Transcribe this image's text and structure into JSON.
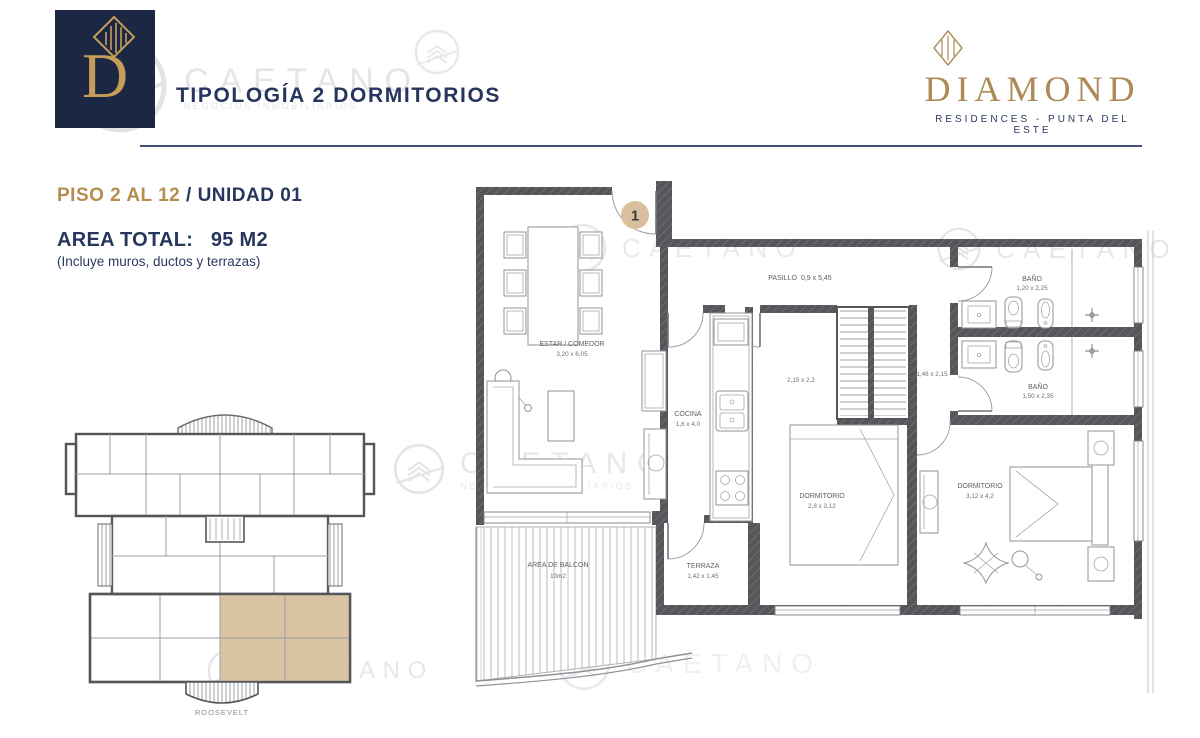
{
  "header": {
    "logo_letter": "D",
    "title": "TIPOLOGÍA 2 DORMITORIOS",
    "brand_name": "DIAMOND",
    "brand_subtitle": "RESIDENCES - PUNTA DEL ESTE"
  },
  "unit_info": {
    "floor_range": "PISO 2 AL 12",
    "separator": "/",
    "unit": "UNIDAD 01",
    "area_label": "AREA TOTAL:",
    "area_value": "95 M2",
    "area_note": "(Incluye muros, ductos y terrazas)"
  },
  "floorplan": {
    "entrance_number": "1",
    "rooms": {
      "estar": {
        "name": "ESTAR / COMEDOR",
        "dims": "3,20 x 6,05"
      },
      "pasillo": {
        "name": "PASILLO",
        "dims": "0,9 x 5,45"
      },
      "cocina": {
        "name": "COCINA",
        "dims": "1,6 x 4,0"
      },
      "vestidor": {
        "dims": "2,15 x 2,2"
      },
      "hall": {
        "dims": "1,46 x 2,15"
      },
      "banio_1": {
        "name": "BAÑO",
        "dims": "1,20 x 2,25"
      },
      "banio_2": {
        "name": "BAÑO",
        "dims": "1,50 x 2,35"
      },
      "dormitorio_1": {
        "name": "DORMITORIO",
        "dims": "2,8 x 3,12"
      },
      "dormitorio_2": {
        "name": "DORMITORIO",
        "dims": "3,12 x 4,2"
      },
      "terraza": {
        "name": "TERRAZA",
        "dims": "1,42 x 1,45"
      },
      "balcon": {
        "name": "AREA DE BALCON",
        "dims": "10m2"
      }
    }
  },
  "key_plan": {
    "street_label": "ROOSEVELT"
  },
  "watermark": {
    "text": "CAETANO",
    "subtext": "NEGOCIOS INMOBILIARIOS"
  },
  "colors": {
    "navy": "#24355c",
    "gold": "#b78c4f",
    "brand_gold": "#ab8a56",
    "wall_gray": "#55565a",
    "unit_highlight": "#d9c3a2",
    "entrance_badge": "#d9bf9b",
    "logo_bg": "#1c2743"
  }
}
